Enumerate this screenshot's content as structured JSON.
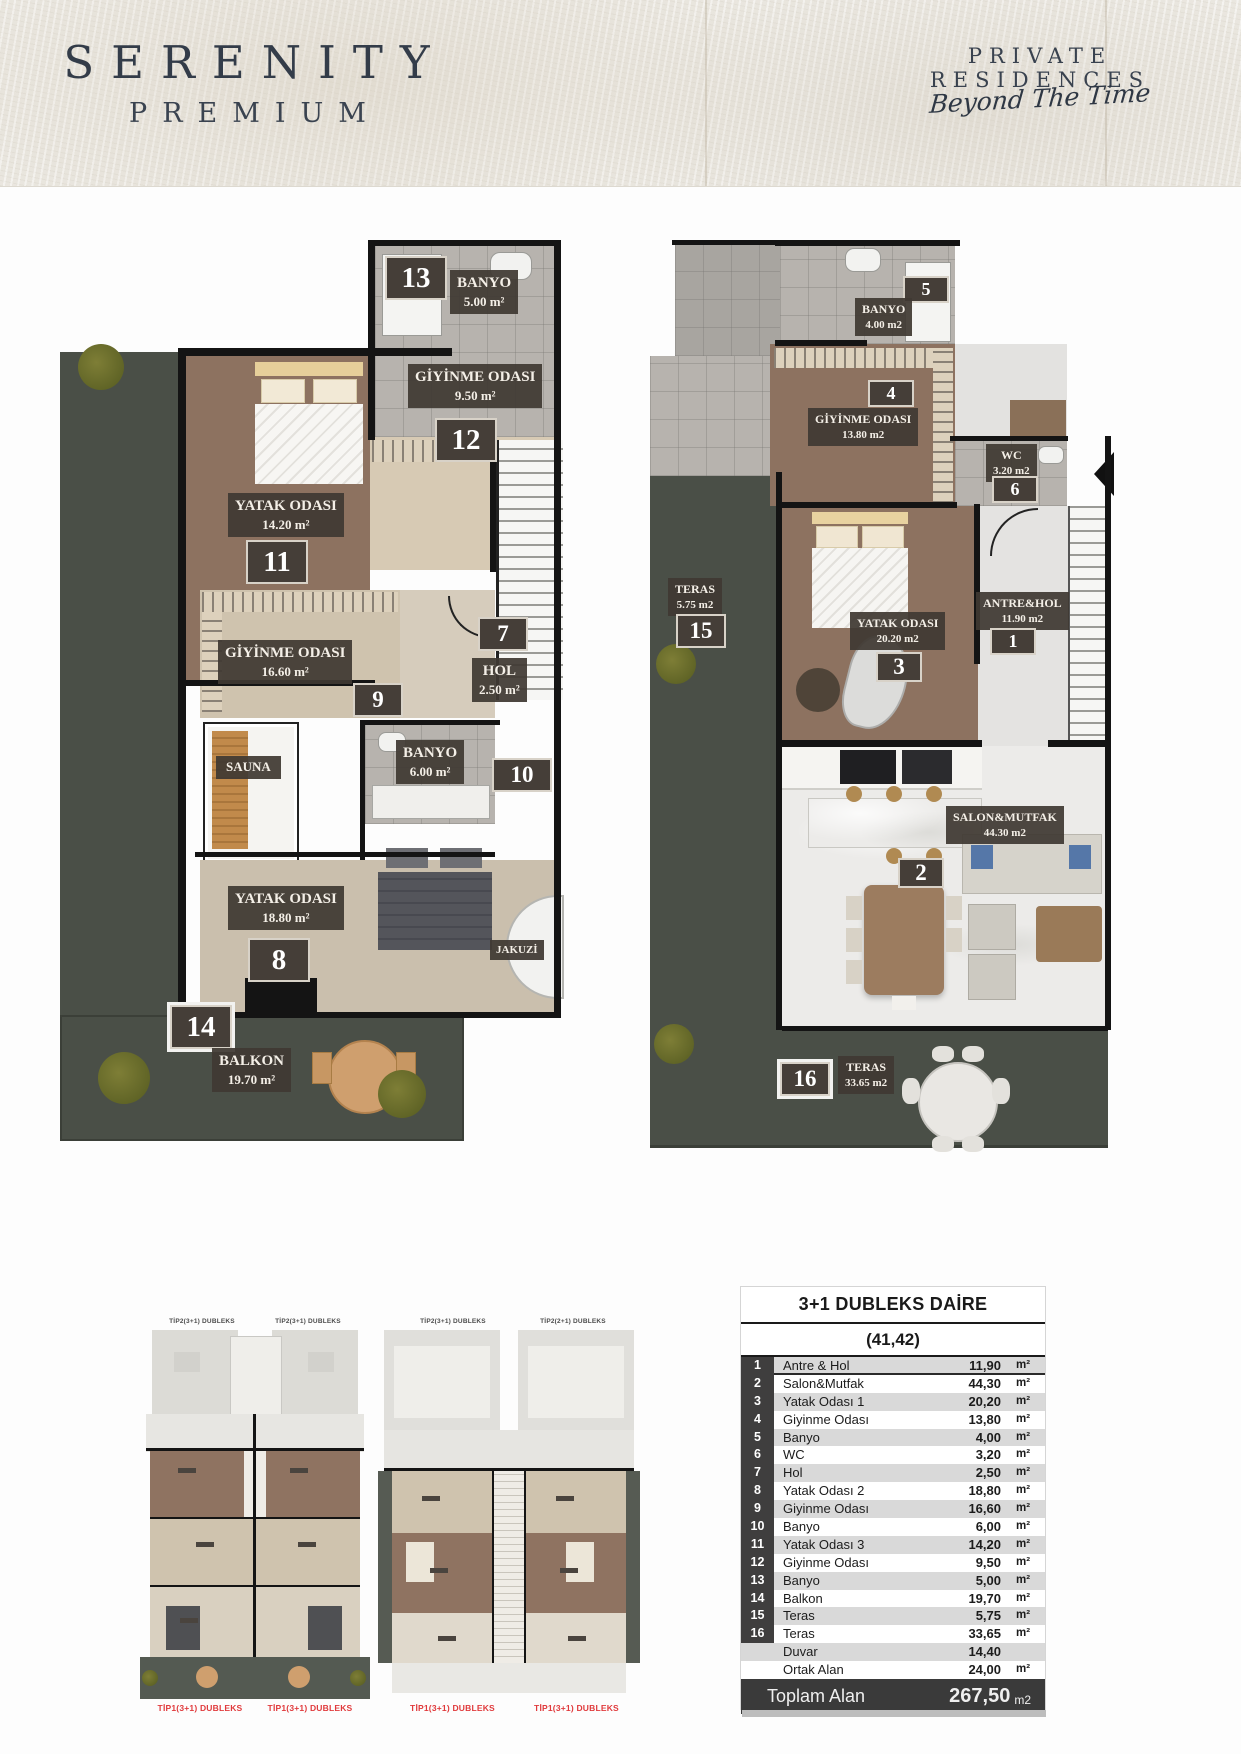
{
  "header": {
    "brand_line1": "SERENITY",
    "brand_line2": "PREMIUM",
    "tagline": "PRIVATE RESIDENCES",
    "script": "Beyond The Time"
  },
  "plans": {
    "upper": {
      "rooms": {
        "banyo13": {
          "badge": "13",
          "name": "BANYO",
          "area": "5.00 m²"
        },
        "giyinme12": {
          "badge": "12",
          "name": "GİYİNME ODASI",
          "area": "9.50 m²"
        },
        "yatak11": {
          "badge": "11",
          "name": "YATAK ODASI",
          "area": "14.20 m²"
        },
        "giyinme9": {
          "badge": "9",
          "name": "GİYİNME ODASI",
          "area": "16.60 m²"
        },
        "hol7": {
          "badge": "7",
          "name": "HOL",
          "area": "2.50 m²"
        },
        "banyo10": {
          "badge": "10",
          "name": "BANYO",
          "area": "6.00 m²"
        },
        "yatak8": {
          "badge": "8",
          "name": "YATAK ODASI",
          "area": "18.80 m²"
        },
        "balkon14": {
          "badge": "14",
          "name": "BALKON",
          "area": "19.70 m²"
        },
        "sauna": {
          "name": "SAUNA"
        },
        "jakuzi": {
          "name": "JAKUZİ"
        }
      }
    },
    "lower": {
      "rooms": {
        "banyo5": {
          "badge": "5",
          "name": "BANYO",
          "area": "4.00 m2"
        },
        "giyinme4": {
          "badge": "4",
          "name": "GİYİNME ODASI",
          "area": "13.80 m2"
        },
        "wc6": {
          "badge": "6",
          "name": "WC",
          "area": "3.20 m2"
        },
        "teras15": {
          "badge": "15",
          "name": "TERAS",
          "area": "5.75 m2"
        },
        "yatak3": {
          "badge": "3",
          "name": "YATAK ODASI",
          "area": "20.20 m2"
        },
        "antre1": {
          "badge": "1",
          "name": "ANTRE&HOL",
          "area": "11.90 m2"
        },
        "salon2": {
          "badge": "2",
          "name": "SALON&MUTFAK",
          "area": "44.30 m2"
        },
        "teras16": {
          "badge": "16",
          "name": "TERAS",
          "area": "33.65 m2"
        }
      }
    }
  },
  "keyplans": {
    "plan1": {
      "top_labels": [
        "TİP2(3+1) DUBLEKS",
        "TİP2(3+1) DUBLEKS"
      ],
      "bottom_labels": [
        "TİP1(3+1) DUBLEKS",
        "TİP1(3+1) DUBLEKS"
      ]
    },
    "plan2": {
      "top_labels": [
        "TİP2(3+1) DUBLEKS",
        "TİP2(2+1) DUBLEKS"
      ],
      "bottom_labels": [
        "TİP1(3+1) DUBLEKS",
        "TİP1(3+1) DUBLEKS"
      ]
    }
  },
  "table": {
    "title": "3+1 DUBLEKS DAİRE",
    "subtitle": "(41,42)",
    "rows": [
      {
        "no": "1",
        "name": "Antre & Hol",
        "value": "11,90",
        "unit": "m²"
      },
      {
        "no": "2",
        "name": "Salon&Mutfak",
        "value": "44,30",
        "unit": "m²"
      },
      {
        "no": "3",
        "name": "Yatak Odası 1",
        "value": "20,20",
        "unit": "m²"
      },
      {
        "no": "4",
        "name": "Giyinme Odası",
        "value": "13,80",
        "unit": "m²"
      },
      {
        "no": "5",
        "name": "Banyo",
        "value": "4,00",
        "unit": "m²"
      },
      {
        "no": "6",
        "name": "WC",
        "value": "3,20",
        "unit": "m²"
      },
      {
        "no": "7",
        "name": "Hol",
        "value": "2,50",
        "unit": "m²"
      },
      {
        "no": "8",
        "name": "Yatak Odası 2",
        "value": "18,80",
        "unit": "m²"
      },
      {
        "no": "9",
        "name": "Giyinme Odası",
        "value": "16,60",
        "unit": "m²"
      },
      {
        "no": "10",
        "name": "Banyo",
        "value": "6,00",
        "unit": "m²"
      },
      {
        "no": "11",
        "name": "Yatak Odası 3",
        "value": "14,20",
        "unit": "m²"
      },
      {
        "no": "12",
        "name": "Giyinme Odası",
        "value": "9,50",
        "unit": "m²"
      },
      {
        "no": "13",
        "name": "Banyo",
        "value": "5,00",
        "unit": "m²"
      },
      {
        "no": "14",
        "name": "Balkon",
        "value": "19,70",
        "unit": "m²"
      },
      {
        "no": "15",
        "name": "Teras",
        "value": "5,75",
        "unit": "m²"
      },
      {
        "no": "16",
        "name": "Teras",
        "value": "33,65",
        "unit": "m²"
      },
      {
        "no": "",
        "name": "Duvar",
        "value": "14,40",
        "unit": ""
      },
      {
        "no": "",
        "name": "Ortak Alan",
        "value": "24,00",
        "unit": "m²"
      }
    ],
    "footer": {
      "label": "Toplam Alan",
      "value": "267,50",
      "unit": "m2"
    }
  },
  "colors": {
    "accent_red": "#e03a3c",
    "badge_bg": "#453e38",
    "terrace": "#4a4f47",
    "wood_dark": "#8d7260",
    "wood_light": "#cdc2b0",
    "table_dark": "#3d3d3d",
    "table_stripe": "#d9d9d9",
    "header_bg": "#eae7e0"
  }
}
